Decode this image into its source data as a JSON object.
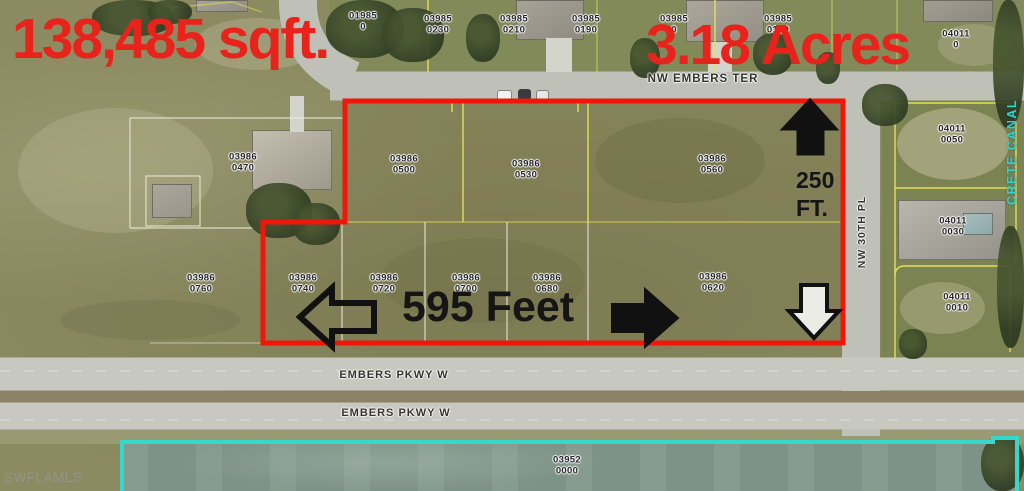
{
  "annotations": {
    "area_sqft": "138,485 sqft.",
    "area_acres": "3.18 Acres",
    "width_label": "595 Feet",
    "depth_line1": "250",
    "depth_line2": "FT.",
    "accent_red": "#e8231c",
    "boundary_red": "#f2150a",
    "canal_cyan": "#35d8cc"
  },
  "streets": {
    "nw_embers_ter": "NW EMBERS TER",
    "embers_pkwy_w_north": "EMBERS PKWY W",
    "embers_pkwy_w_south": "EMBERS PKWY W",
    "nw_30th_pl": "NW 30TH PL",
    "crete_canal": "CRETE CANAL"
  },
  "watermark": "SWFLAMLS",
  "parcel_labels": [
    {
      "line1": "01985",
      "line2": "0",
      "x": 363,
      "y": 22
    },
    {
      "line1": "03985",
      "line2": "0230",
      "x": 438,
      "y": 25
    },
    {
      "line1": "03985",
      "line2": "0210",
      "x": 514,
      "y": 25
    },
    {
      "line1": "03985",
      "line2": "0190",
      "x": 586,
      "y": 25
    },
    {
      "line1": "03985",
      "line2": "0",
      "x": 674,
      "y": 25
    },
    {
      "line1": "03985",
      "line2": "0130",
      "x": 778,
      "y": 25
    },
    {
      "line1": "04011",
      "line2": "0",
      "x": 956,
      "y": 40
    },
    {
      "line1": "03986",
      "line2": "0470",
      "x": 243,
      "y": 163
    },
    {
      "line1": "03986",
      "line2": "0500",
      "x": 404,
      "y": 165
    },
    {
      "line1": "03986",
      "line2": "0530",
      "x": 526,
      "y": 170
    },
    {
      "line1": "03986",
      "line2": "0560",
      "x": 712,
      "y": 165
    },
    {
      "line1": "03986",
      "line2": "0760",
      "x": 201,
      "y": 284
    },
    {
      "line1": "03986",
      "line2": "0740",
      "x": 303,
      "y": 284
    },
    {
      "line1": "03986",
      "line2": "0720",
      "x": 384,
      "y": 284
    },
    {
      "line1": "03986",
      "line2": "0700",
      "x": 466,
      "y": 284
    },
    {
      "line1": "03986",
      "line2": "0680",
      "x": 547,
      "y": 284
    },
    {
      "line1": "03986",
      "line2": "0620",
      "x": 713,
      "y": 283
    },
    {
      "line1": "04011",
      "line2": "0050",
      "x": 952,
      "y": 135
    },
    {
      "line1": "04011",
      "line2": "0030",
      "x": 953,
      "y": 227
    },
    {
      "line1": "04011",
      "line2": "0010",
      "x": 957,
      "y": 303
    },
    {
      "line1": "03952",
      "line2": "0000",
      "x": 567,
      "y": 466
    }
  ]
}
